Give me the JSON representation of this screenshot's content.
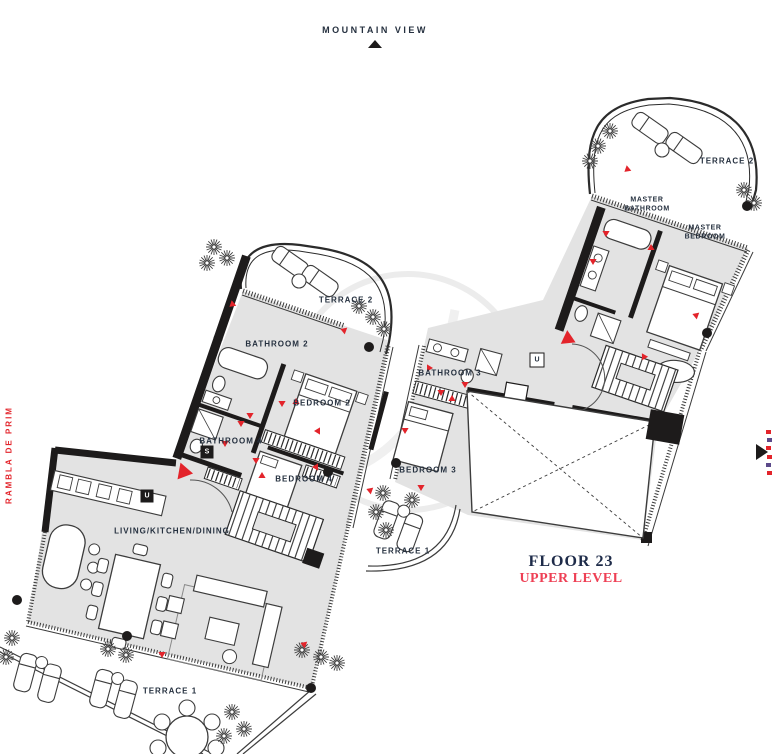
{
  "compass": {
    "top_label": "MOUNTAIN VIEW",
    "left_street": "RAMBLA DE PRIM"
  },
  "caption": {
    "floor": "FLOOR 23",
    "level": "UPPER LEVEL"
  },
  "lower_level": {
    "terrace2": "TERRACE 2",
    "bathroom2": "BATHROOM 2",
    "bedroom2": "BEDROOM 2",
    "bathroom4": "BATHROOM 4",
    "storage": "S",
    "bedroom4": "BEDROOM 4",
    "utility": "U",
    "living": "LIVING/KITCHEN/DINING",
    "terrace1": "TERRACE 1"
  },
  "upper_level": {
    "terrace2": "TERRACE 2",
    "master_bathroom_line1": "MASTER",
    "master_bathroom_line2": "BATHROOM",
    "master_bedroom_line1": "MASTER",
    "master_bedroom_line2": "BEDROOM",
    "utility": "U",
    "bathroom3": "BATHROOM 3",
    "bedroom3": "BEDROOM 3",
    "terrace1": "TERRACE 1"
  },
  "colors": {
    "accent_red": "#E3242B",
    "label_navy": "#25303F",
    "caption_navy": "#1E2B49",
    "caption_red": "#EE4055",
    "room_fill": "#E3E3E3",
    "wall": "#1D1B1B"
  }
}
